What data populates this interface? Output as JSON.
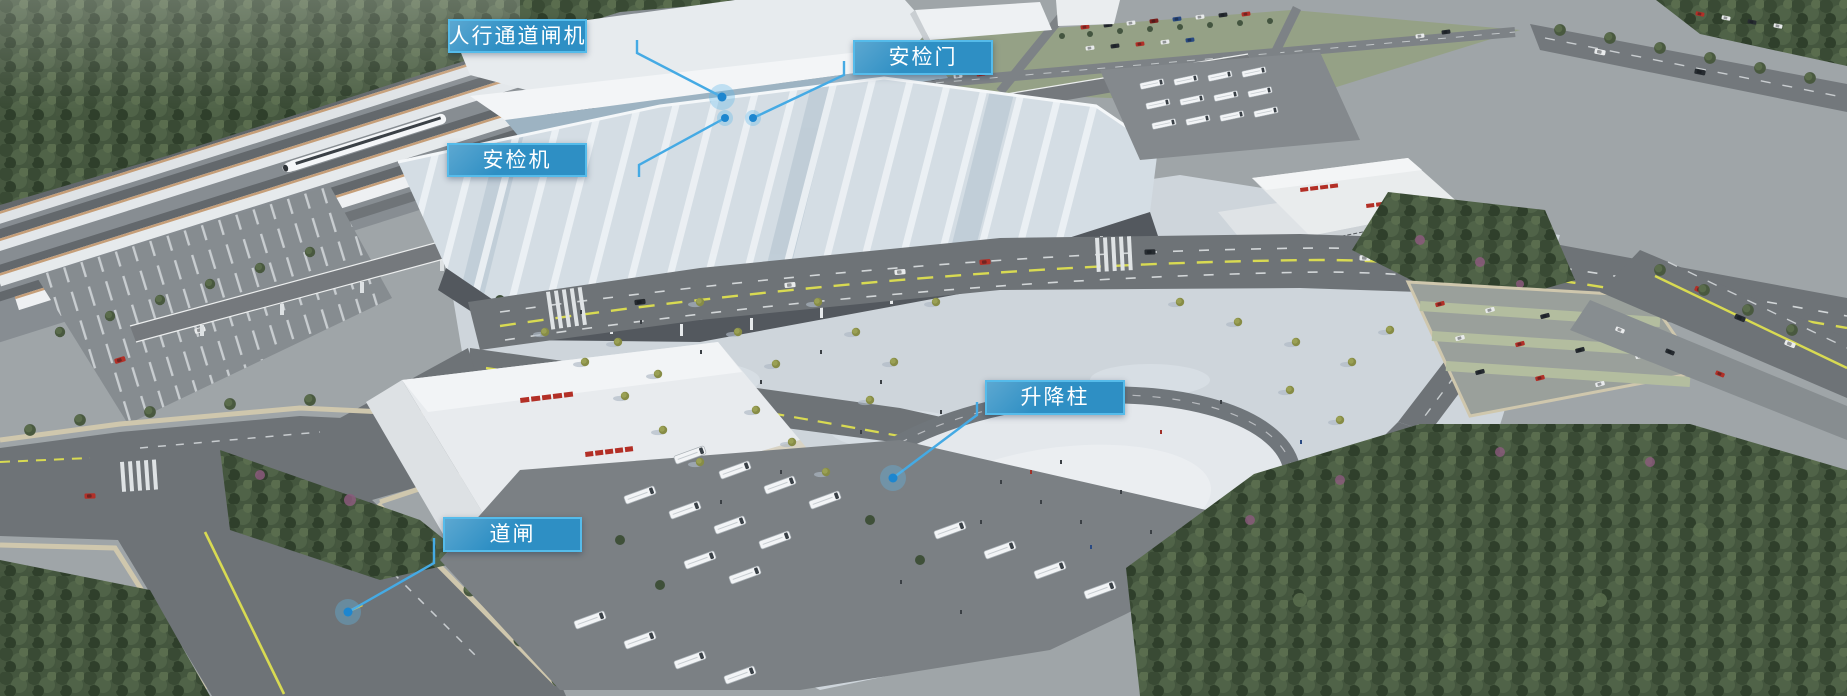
{
  "callouts": [
    {
      "id": "pedestrian-channel-gate",
      "label": "人行通道闸机"
    },
    {
      "id": "security-door",
      "label": "安检门"
    },
    {
      "id": "security-scanner",
      "label": "安检机"
    },
    {
      "id": "lifting-bollard",
      "label": "升降柱"
    },
    {
      "id": "road-barrier",
      "label": "道闸"
    }
  ],
  "colors": {
    "label_bg": "#2E8FC4",
    "label_border": "#55BBEA",
    "label_text": "#FFFFFF",
    "leader_line": "#45AAE4",
    "marker_dot": "#1D86CF",
    "marker_halo": "#5FB6E8"
  }
}
